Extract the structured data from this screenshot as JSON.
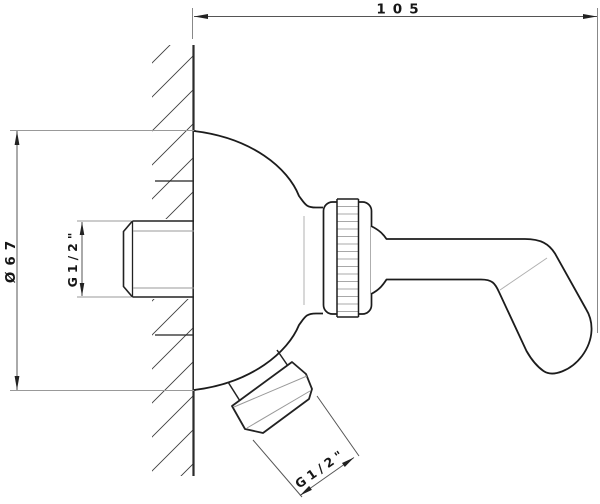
{
  "drawing": {
    "type": "technical-line-drawing",
    "subject": "wall-mounted shower bracket, side section view",
    "labels": {
      "width": "105",
      "diameter": "Ø67",
      "thread_inlet": "G1/2\"",
      "thread_outlet": "G1/2\""
    },
    "colors": {
      "outline": "#1c1c1c",
      "dimension_line": "#555555",
      "detail_gray": "#999999",
      "background": "#ffffff"
    }
  }
}
